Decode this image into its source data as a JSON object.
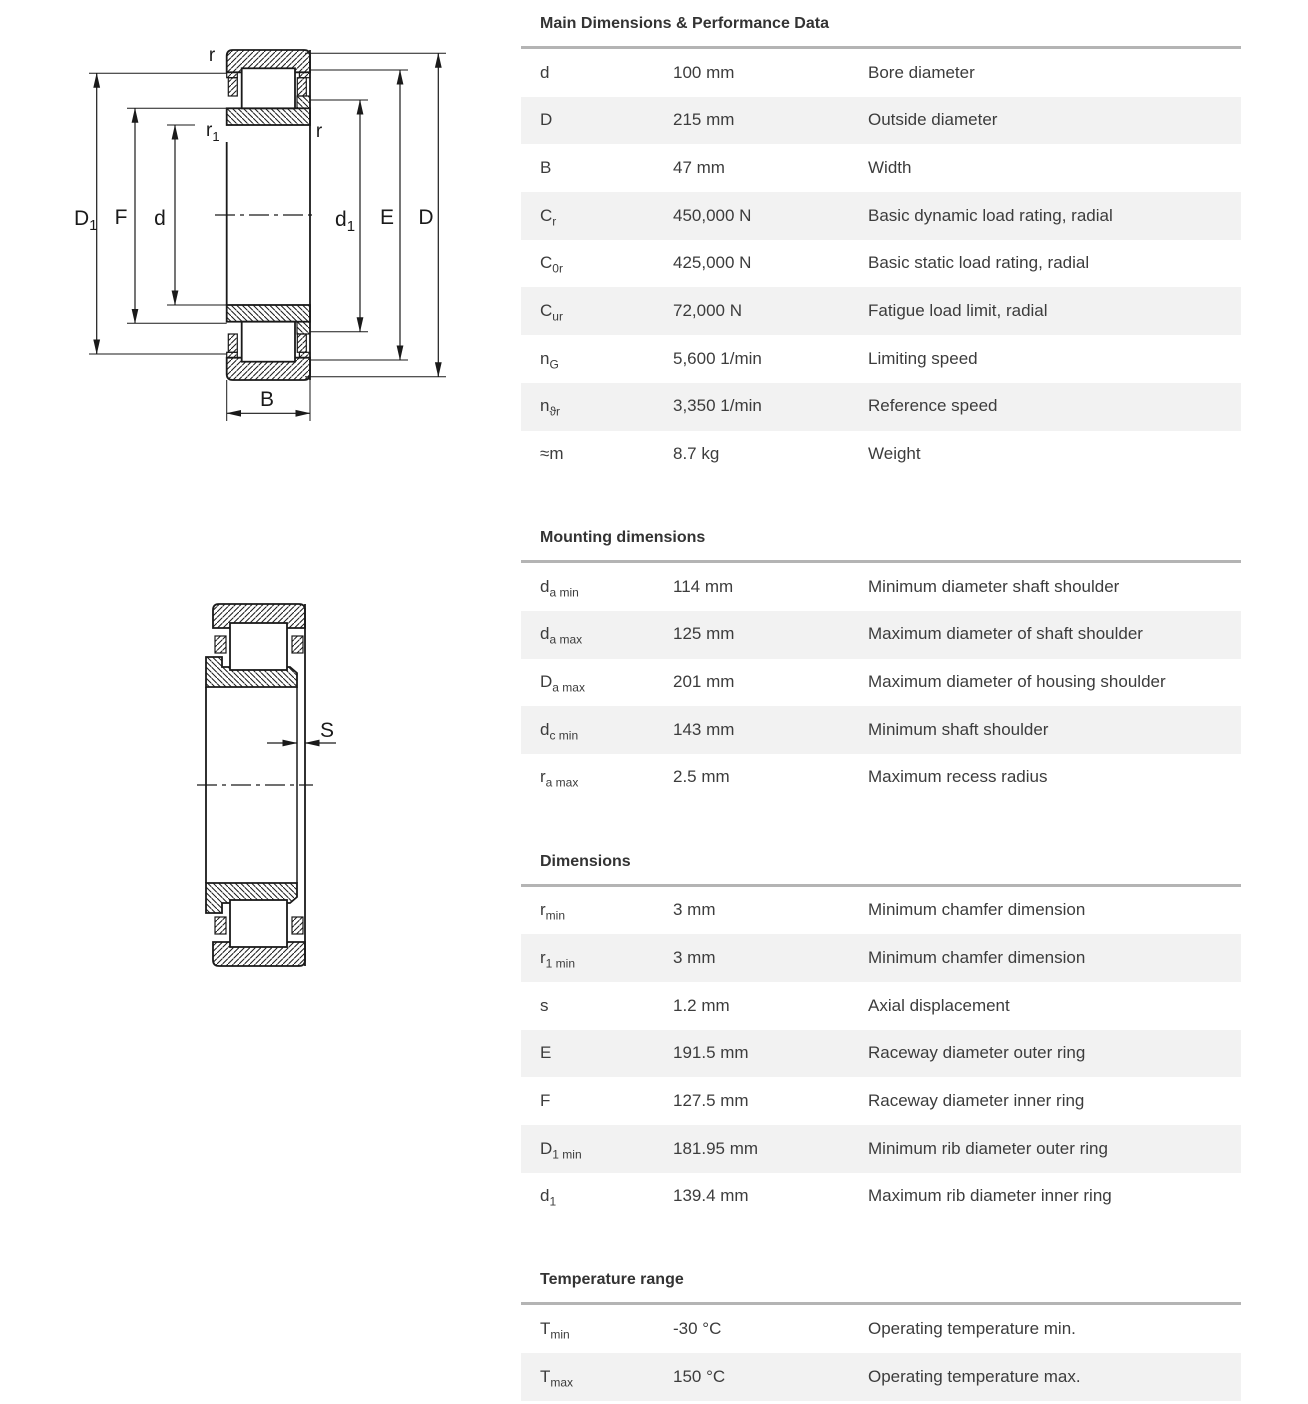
{
  "page": {
    "background": "#ffffff",
    "row_alt_bg": "#f2f2f2",
    "table_border": "#b4b4b4",
    "text_color": "#3c3c3c"
  },
  "sections": [
    {
      "title": "Main Dimensions & Performance Data",
      "rows": [
        {
          "symbol": "d",
          "sub": "",
          "value": "100 mm",
          "desc": "Bore diameter"
        },
        {
          "symbol": "D",
          "sub": "",
          "value": "215 mm",
          "desc": "Outside diameter"
        },
        {
          "symbol": "B",
          "sub": "",
          "value": "47 mm",
          "desc": "Width"
        },
        {
          "symbol": "C",
          "sub": "r",
          "value": "450,000 N",
          "desc": "Basic dynamic load rating, radial"
        },
        {
          "symbol": "C",
          "sub": "0r",
          "value": "425,000 N",
          "desc": "Basic static load rating, radial"
        },
        {
          "symbol": "C",
          "sub": "ur",
          "value": "72,000 N",
          "desc": "Fatigue load limit, radial"
        },
        {
          "symbol": "n",
          "sub": "G",
          "value": "5,600 1/min",
          "desc": "Limiting speed"
        },
        {
          "symbol": "n",
          "sub": "ϑr",
          "value": "3,350 1/min",
          "desc": "Reference speed"
        },
        {
          "symbol": "≈m",
          "sub": "",
          "value": "8.7 kg",
          "desc": "Weight"
        }
      ]
    },
    {
      "title": "Mounting dimensions",
      "rows": [
        {
          "symbol": "d",
          "sub": "a min",
          "value": "114 mm",
          "desc": "Minimum diameter shaft shoulder"
        },
        {
          "symbol": "d",
          "sub": "a max",
          "value": "125 mm",
          "desc": "Maximum diameter of shaft shoulder"
        },
        {
          "symbol": "D",
          "sub": "a max",
          "value": "201 mm",
          "desc": "Maximum diameter of housing shoulder"
        },
        {
          "symbol": "d",
          "sub": "c min",
          "value": "143 mm",
          "desc": "Minimum shaft shoulder"
        },
        {
          "symbol": "r",
          "sub": "a max",
          "value": "2.5 mm",
          "desc": "Maximum recess radius"
        }
      ]
    },
    {
      "title": "Dimensions",
      "rows": [
        {
          "symbol": "r",
          "sub": "min",
          "value": "3 mm",
          "desc": "Minimum chamfer dimension"
        },
        {
          "symbol": "r",
          "sub": "1 min",
          "value": "3 mm",
          "desc": "Minimum chamfer dimension"
        },
        {
          "symbol": "s",
          "sub": "",
          "value": "1.2 mm",
          "desc": "Axial displacement"
        },
        {
          "symbol": "E",
          "sub": "",
          "value": "191.5 mm",
          "desc": "Raceway diameter outer ring"
        },
        {
          "symbol": "F",
          "sub": "",
          "value": "127.5 mm",
          "desc": "Raceway diameter inner ring"
        },
        {
          "symbol": "D",
          "sub": "1 min",
          "value": "181.95 mm",
          "desc": "Minimum rib diameter outer ring"
        },
        {
          "symbol": "d",
          "sub": "1",
          "value": "139.4 mm",
          "desc": "Maximum rib diameter inner ring"
        }
      ]
    },
    {
      "title": "Temperature range",
      "rows": [
        {
          "symbol": "T",
          "sub": "min",
          "value": "-30 °C",
          "desc": "Operating temperature min."
        },
        {
          "symbol": "T",
          "sub": "max",
          "value": "150 °C",
          "desc": "Operating temperature max."
        }
      ]
    }
  ],
  "diagrams": {
    "main_view": {
      "labels": {
        "r_top": "r",
        "r1": {
          "main": "r",
          "sub": "1"
        },
        "r_right": "r",
        "D1": {
          "main": "D",
          "sub": "1"
        },
        "F": "F",
        "d": "d",
        "d1": {
          "main": "d",
          "sub": "1"
        },
        "E": "E",
        "D": "D",
        "B": "B"
      }
    },
    "displacement_view": {
      "labels": {
        "S": "S"
      }
    }
  }
}
